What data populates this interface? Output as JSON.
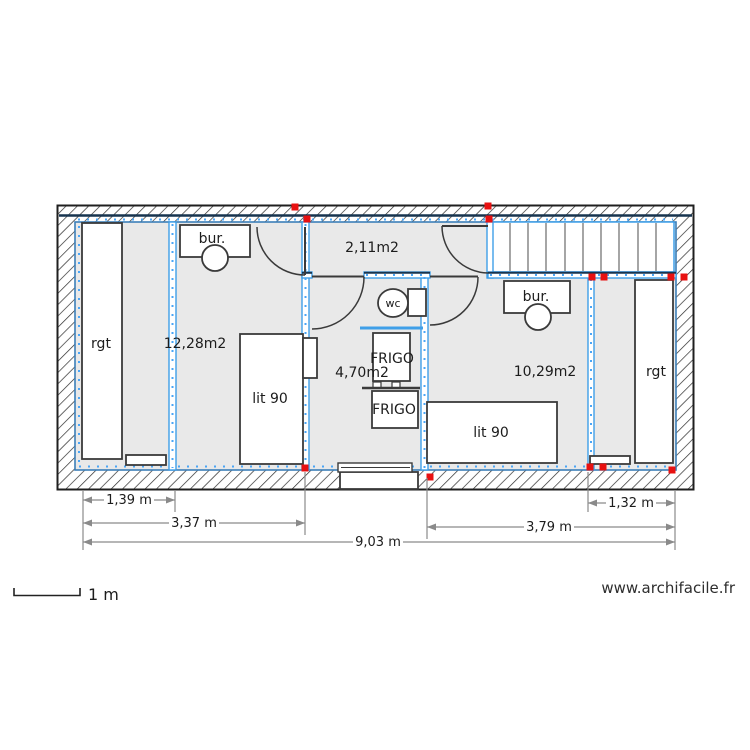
{
  "plan": {
    "rooms": {
      "storage_left": {
        "label": "rgt"
      },
      "bedroom_left": {
        "area_label": "12,28m2",
        "desk_label": "bur.",
        "bed_label": "lit 90"
      },
      "hallway": {
        "area_label": "2,11m2"
      },
      "kitchen_wc": {
        "area_label": "4,70m2",
        "toilet_label": "wc",
        "fridge_top_label": "FRIGO",
        "fridge_bottom_label": "FRIGO"
      },
      "bedroom_right": {
        "area_label": "10,29m2",
        "desk_label": "bur.",
        "bed_label": "lit 90"
      },
      "storage_right": {
        "label": "rgt"
      }
    },
    "dimensions": {
      "storage_left_width": "1,39 m",
      "left_section_width": "3,37 m",
      "total_width": "9,03 m",
      "storage_right_width": "1,32 m",
      "right_section_width": "3,79 m"
    }
  },
  "scale_bar": {
    "label": "1 m"
  },
  "watermark": "www.archifacile.fr",
  "colors": {
    "wall_blue": "#3f9fe8",
    "wall_navy": "#17344f",
    "junction_marker_red": "#e81111",
    "floor_gray": "#e9e9e9",
    "hatch_black": "#2b2b2b",
    "dimension_gray": "#8a8a8a"
  }
}
